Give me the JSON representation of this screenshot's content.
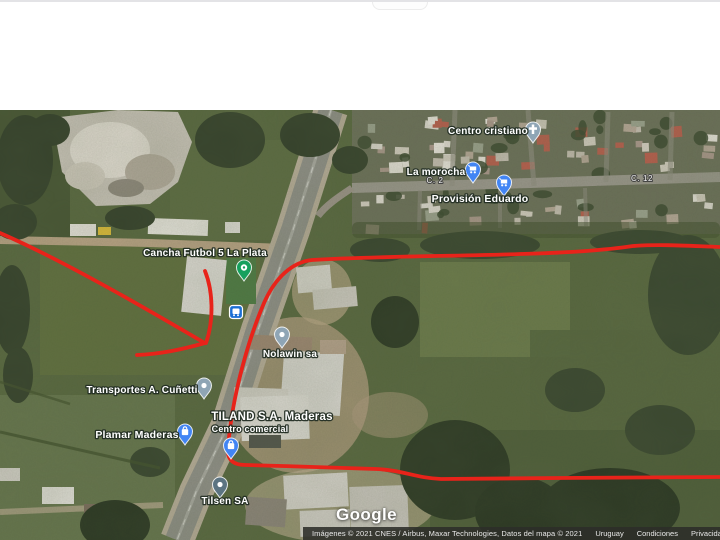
{
  "map": {
    "google_logo": "Google",
    "attribution": {
      "imagery": "Imágenes © 2021 CNES / Airbus, Maxar Technologies, Datos del mapa © 2021",
      "links": [
        "Uruguay",
        "Condiciones",
        "Privacidad",
        "E"
      ]
    },
    "poi_labels": [
      {
        "name": "centro-cristiano",
        "text": "Centro cristiano",
        "x": 488,
        "y": 134,
        "size": 10
      },
      {
        "name": "la-morocha",
        "text": "La morocha",
        "x": 436,
        "y": 175,
        "size": 10
      },
      {
        "name": "provision-eduardo",
        "text": "Provisión Eduardo",
        "x": 480,
        "y": 202,
        "size": 10.5
      },
      {
        "name": "cancha-futbol",
        "text": "Cancha Futbol 5 La Plata",
        "x": 205,
        "y": 256,
        "size": 10
      },
      {
        "name": "nolawin",
        "text": "Nolawin sa",
        "x": 290,
        "y": 357,
        "size": 10
      },
      {
        "name": "transportes-cunetti",
        "text": "Transportes A. Cuñetti",
        "x": 142,
        "y": 393,
        "size": 10
      },
      {
        "name": "plamar-maderas",
        "text": "Plamar Maderas",
        "x": 137,
        "y": 438,
        "size": 10.5
      },
      {
        "name": "tiland-maderas",
        "text": "TILAND S.A. Maderas",
        "x": 272,
        "y": 420,
        "size": 11.5
      },
      {
        "name": "tiland-centro-comercial",
        "text": "Centro comercial",
        "x": 250,
        "y": 432,
        "size": 9
      },
      {
        "name": "tilsen",
        "text": "Tilsen SA",
        "x": 225,
        "y": 504,
        "size": 10
      }
    ],
    "street_labels": [
      {
        "name": "street-c2",
        "text": "C. 2",
        "x": 435,
        "y": 183,
        "size": 8
      },
      {
        "name": "street-c12",
        "text": "C. 12",
        "x": 642,
        "y": 181,
        "size": 8
      }
    ],
    "pins": [
      {
        "name": "centro-cristiano",
        "type": "teardrop",
        "color": "#8fa5b5",
        "glyph": "cross",
        "x": 533,
        "y": 143
      },
      {
        "name": "la-morocha",
        "type": "teardrop",
        "color": "#4285f4",
        "glyph": "cart",
        "x": 473,
        "y": 183
      },
      {
        "name": "provision-eduardo",
        "type": "teardrop",
        "color": "#4285f4",
        "glyph": "cart",
        "x": 504,
        "y": 196
      },
      {
        "name": "cancha-futbol",
        "type": "teardrop",
        "color": "#16a05d",
        "glyph": "sport",
        "x": 244,
        "y": 281
      },
      {
        "name": "nolawin",
        "type": "teardrop",
        "color": "#8fa5b5",
        "glyph": "dot",
        "x": 282,
        "y": 348
      },
      {
        "name": "transportes-cunetti",
        "type": "teardrop",
        "color": "#8fa5b5",
        "glyph": "dot",
        "x": 204,
        "y": 399
      },
      {
        "name": "plamar-maderas",
        "type": "teardrop",
        "color": "#4285f4",
        "glyph": "bag",
        "x": 185,
        "y": 445
      },
      {
        "name": "tiland-maderas",
        "type": "teardrop",
        "color": "#4285f4",
        "glyph": "bag",
        "x": 231,
        "y": 459
      },
      {
        "name": "tilsen",
        "type": "teardrop",
        "color": "#5c7482",
        "glyph": "dot",
        "x": 220,
        "y": 498
      },
      {
        "name": "bus-stop",
        "type": "square",
        "color": "#1c6fd4",
        "glyph": "bus",
        "x": 236,
        "y": 312
      }
    ]
  },
  "annotation": {
    "color": "#e8231a",
    "width": 3.8,
    "paths": [
      {
        "name": "red-line-west",
        "d": "M 0 233 C 60 259 140 305 203 342"
      },
      {
        "name": "red-line-tail",
        "d": "M 205 343 C 180 350 160 354 137 355"
      },
      {
        "name": "red-line-spur",
        "d": "M 205 271 C 213 291 214 320 206 343"
      },
      {
        "name": "red-boundary",
        "d": "M 720 247 C 690 246 662 244 633 246 C 600 251 560 253 520 254 C 470 256 380 256 312 260 C 292 262 275 278 264 303 C 249 338 232 395 228 448 C 227 460 233 465 246 465 C 290 466 340 468 376 469 C 402 470 416 478 441 479 L 560 478 L 720 477"
      }
    ]
  }
}
